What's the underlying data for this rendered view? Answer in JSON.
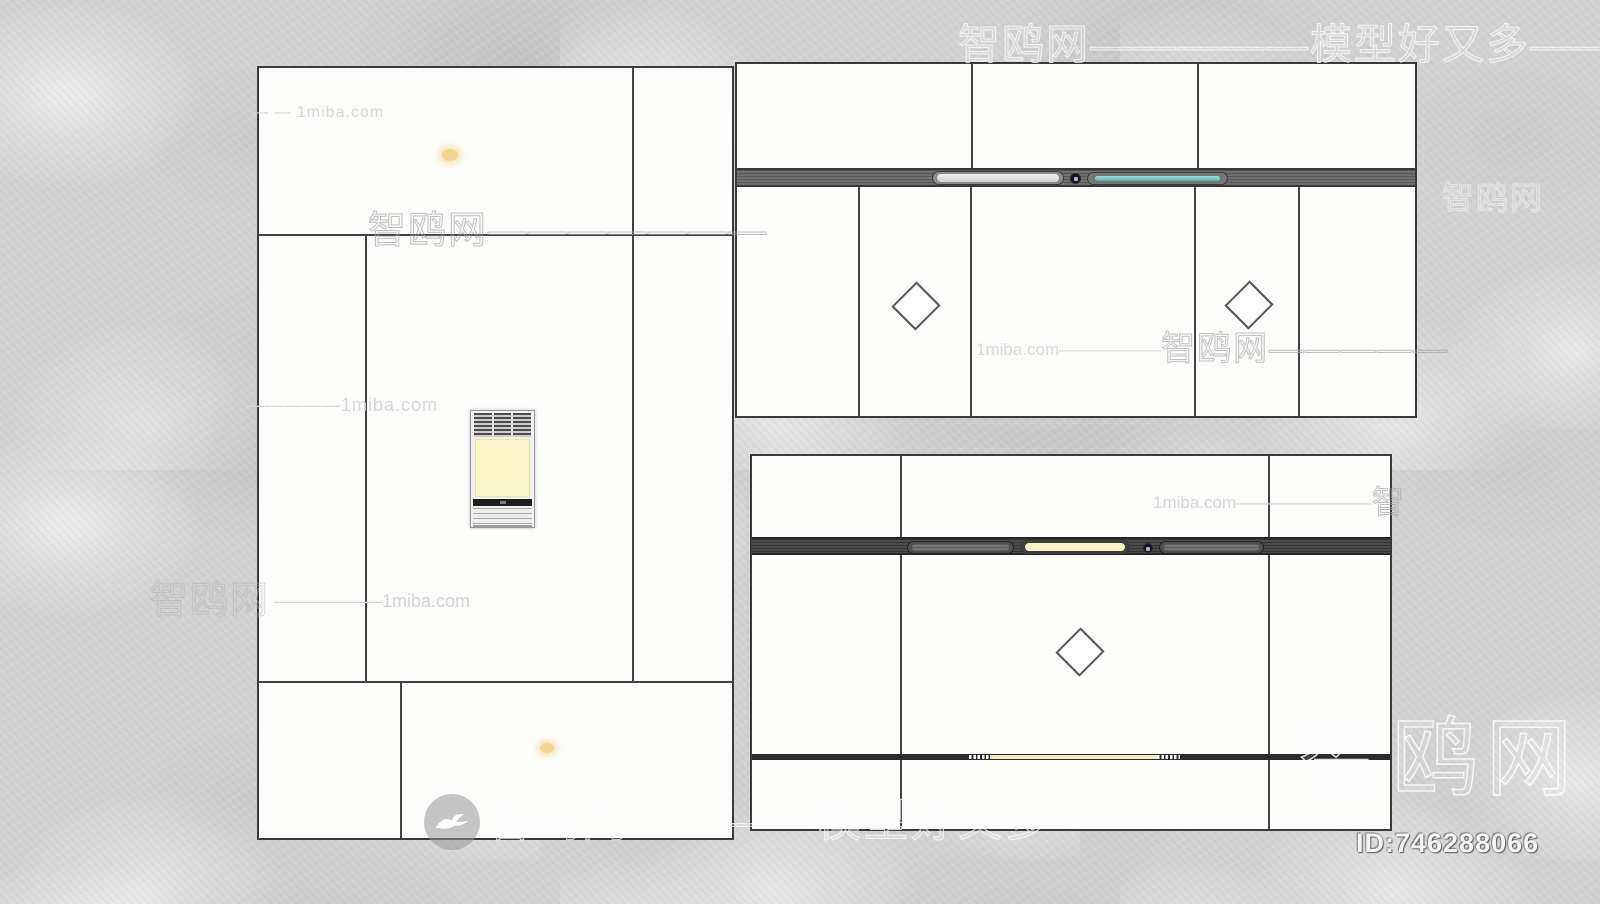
{
  "brand": {
    "name_cn": "智鸥网",
    "site": "1miba.com",
    "slogan": "模型好又多",
    "model_id": "ID:746288066"
  },
  "watermarks": {
    "left_top": "— — 1miba.com",
    "mid_left_row": {
      "cjk": "智鸥网",
      "dashes": "———————"
    },
    "left_mid": "—————1miba.com",
    "lower_left_row": {
      "cjk": "智鸥网",
      "rest": "——————1miba.com"
    },
    "top_row": {
      "cjk1": "智鸥网",
      "d1": "—————",
      "cjk2": "模型好又多",
      "d2": "————"
    },
    "right_mid_row": {
      "site1": "1miba.com",
      "d1": "——————",
      "cjk": "智鸥网",
      "d2": "—————",
      "site2": "1miba.com"
    },
    "right_lower_row": {
      "site": "1miba.com",
      "d": "————————",
      "cjk": "智"
    },
    "right_edge_faint": "智鸥网",
    "bottom_row": {
      "cjk1": "智鸥网",
      "d1": "————",
      "cjk2": "模型好又多",
      "d2": "————"
    },
    "big_brand": "智鸥网",
    "id_text": "ID:746288066"
  }
}
